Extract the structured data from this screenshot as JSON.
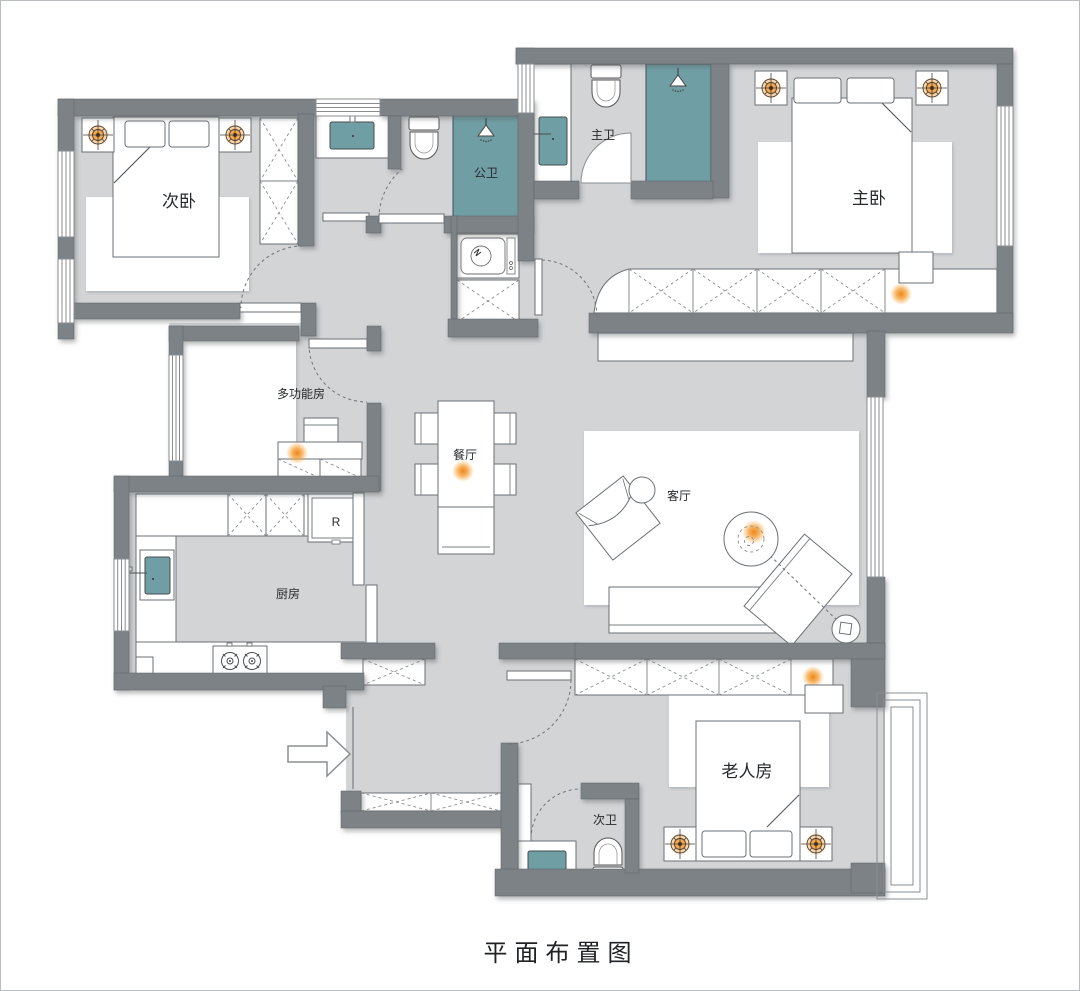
{
  "title": "平面布置图",
  "rooms": {
    "secondary_bedroom": "次卧",
    "public_bathroom": "公卫",
    "master_bathroom": "主卫",
    "master_bedroom": "主卧",
    "multifunction_room": "多功能房",
    "dining_room": "餐厅",
    "kitchen": "厨房",
    "living_room": "客厅",
    "guest_bathroom": "次卫",
    "elderly_room": "老人房"
  },
  "appliances": {
    "fridge_label": "R"
  },
  "colors": {
    "wall": "#7d8286",
    "floor": "#d2d4d6",
    "fixture_teal": "#6f9ea4",
    "accent_orange": "#f08617",
    "line": "#6b7074",
    "background": "#ffffff"
  }
}
